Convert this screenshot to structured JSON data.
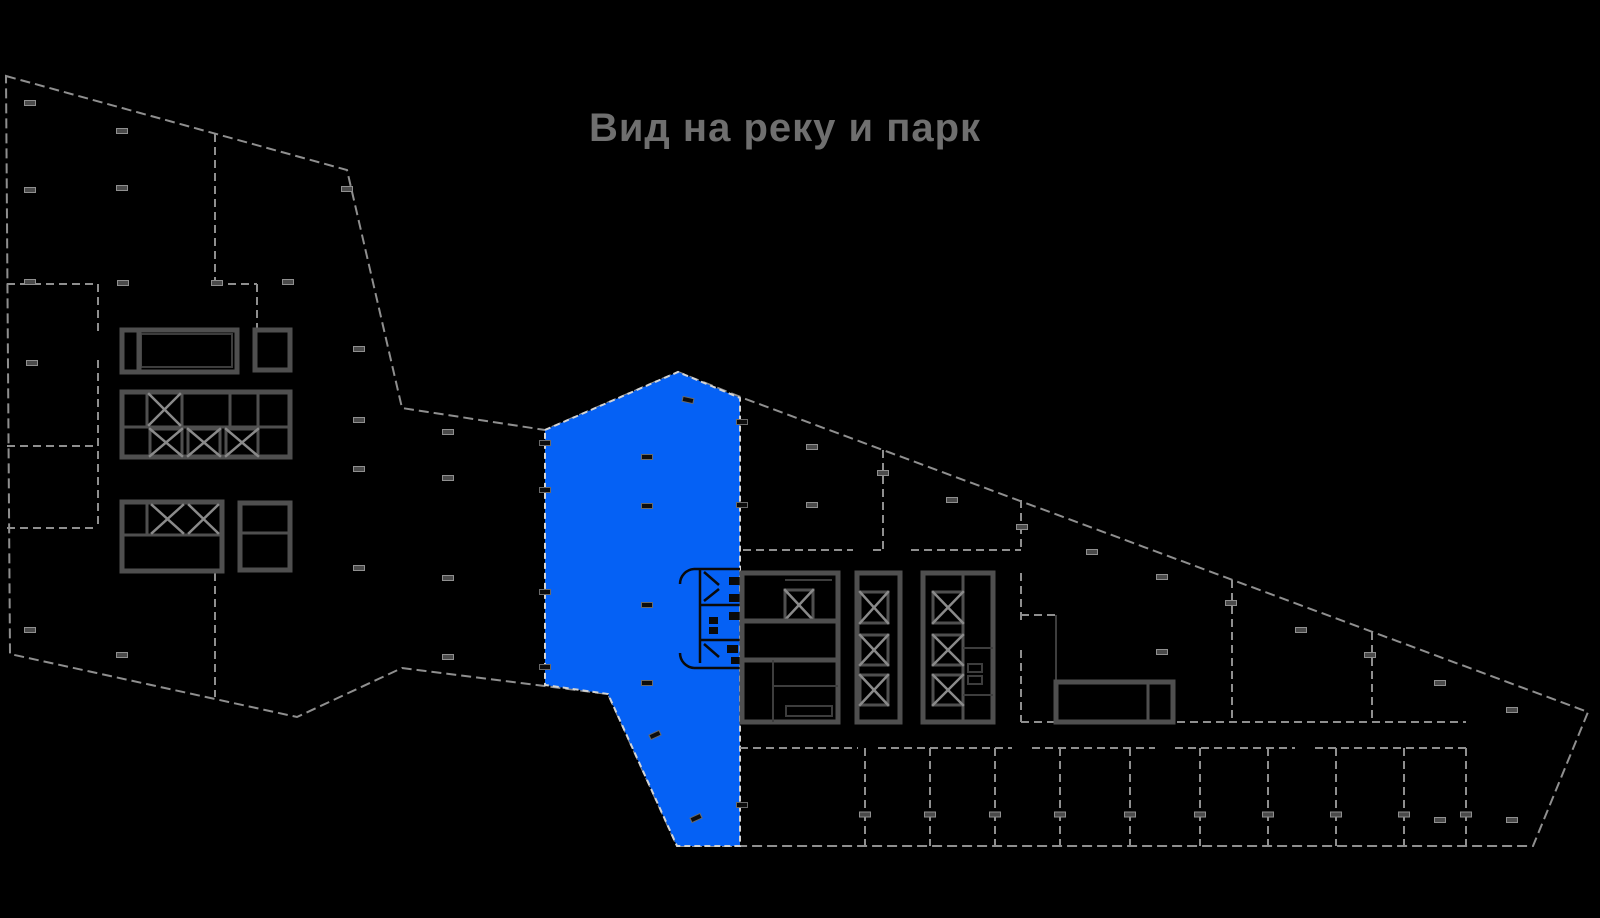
{
  "title": {
    "text": "Вид на реку и парк"
  },
  "colors": {
    "background": "#000000",
    "highlight": "#0561f5",
    "wall_gray": "#8f8f8f",
    "core_wall": "#4f4f4f",
    "stair_x": "#8a8a8a",
    "unit_outline": "#d4d4d4",
    "detail_black": "#0a0a0a",
    "title_color": "#6f6f6f"
  },
  "floor_plan": {
    "highlighted_unit": {
      "id": "unit-with-river-park-view"
    },
    "bottom_room_dividers_x": [
      865,
      930,
      995,
      1060,
      1130,
      1200,
      1268,
      1336,
      1404,
      1466
    ],
    "column_markers": [
      [
        30,
        103,
        0,
        "light"
      ],
      [
        122,
        131,
        0,
        "light"
      ],
      [
        30,
        190,
        0,
        "light"
      ],
      [
        122,
        188,
        0,
        "light"
      ],
      [
        347,
        189,
        0,
        "light"
      ],
      [
        30,
        282,
        0,
        "light"
      ],
      [
        123,
        283,
        0,
        "light"
      ],
      [
        217,
        283,
        0,
        "light"
      ],
      [
        288,
        282,
        0,
        "light"
      ],
      [
        32,
        363,
        0,
        "light"
      ],
      [
        359,
        349,
        0,
        "light"
      ],
      [
        359,
        420,
        0,
        "light"
      ],
      [
        359,
        469,
        0,
        "light"
      ],
      [
        359,
        568,
        0,
        "light"
      ],
      [
        448,
        432,
        0,
        "light"
      ],
      [
        448,
        478,
        0,
        "light"
      ],
      [
        448,
        578,
        0,
        "light"
      ],
      [
        448,
        657,
        0,
        "light"
      ],
      [
        30,
        630,
        0,
        "light"
      ],
      [
        122,
        655,
        0,
        "light"
      ],
      [
        812,
        447,
        0,
        "light"
      ],
      [
        812,
        505,
        0,
        "light"
      ],
      [
        883,
        473,
        0,
        "light"
      ],
      [
        952,
        500,
        0,
        "light"
      ],
      [
        1022,
        527,
        0,
        "light"
      ],
      [
        1092,
        552,
        0,
        "light"
      ],
      [
        1162,
        577,
        0,
        "light"
      ],
      [
        1162,
        652,
        0,
        "light"
      ],
      [
        1231,
        603,
        0,
        "light"
      ],
      [
        1301,
        630,
        0,
        "light"
      ],
      [
        1370,
        655,
        0,
        "light"
      ],
      [
        1440,
        683,
        0,
        "light"
      ],
      [
        1512,
        710,
        0,
        "light"
      ],
      [
        1440,
        820,
        0,
        "light"
      ],
      [
        1512,
        820,
        0,
        "light"
      ],
      [
        545,
        443,
        0,
        "dark"
      ],
      [
        545,
        490,
        0,
        "dark"
      ],
      [
        545,
        592,
        0,
        "dark"
      ],
      [
        545,
        667,
        0,
        "dark"
      ],
      [
        742,
        422,
        0,
        "dark"
      ],
      [
        742,
        505,
        0,
        "dark"
      ],
      [
        742,
        805,
        0,
        "dark"
      ],
      [
        688,
        400,
        12,
        "dark"
      ],
      [
        647,
        457,
        0,
        "dark"
      ],
      [
        647,
        506,
        0,
        "dark"
      ],
      [
        647,
        605,
        0,
        "dark"
      ],
      [
        647,
        683,
        0,
        "dark"
      ],
      [
        655,
        735,
        -25,
        "dark"
      ],
      [
        696,
        818,
        -25,
        "dark"
      ]
    ]
  }
}
